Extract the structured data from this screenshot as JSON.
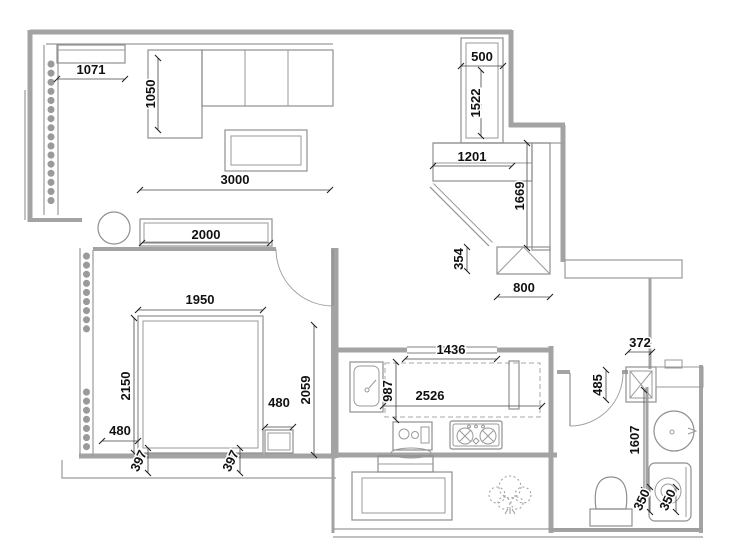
{
  "title": "apartment-floor-plan",
  "colors": {
    "wall": "#a3a3a3",
    "furniture_line": "#8f8f8f",
    "dimension_text": "#111111"
  },
  "dims": {
    "hall_cabinet_width": "1071",
    "sofa_depth": "1050",
    "living_room_width": "3000",
    "tv_cabinet_width": "2000",
    "duct_width": "500",
    "duct_height": "1522",
    "entry_cabinet_width": "1201",
    "entry_cabinet_length": "1669",
    "entry_gap": "354",
    "shoe_cabinet_width": "800",
    "bed_width": "1950",
    "bed_length": "2150",
    "bed_side_gap": "480",
    "bed_foot_gap_left": "397",
    "bed_foot_gap_right": "397",
    "nightstand_width": "480",
    "bedroom_east_length": "2059",
    "kitchen_opening_width": "1436",
    "sink_depth": "987",
    "counter_length": "2526",
    "bath_duct_width": "372",
    "bath_entry_depth": "485",
    "bath_length": "1607",
    "toilet_offset": "350",
    "washer_offset": "350"
  }
}
